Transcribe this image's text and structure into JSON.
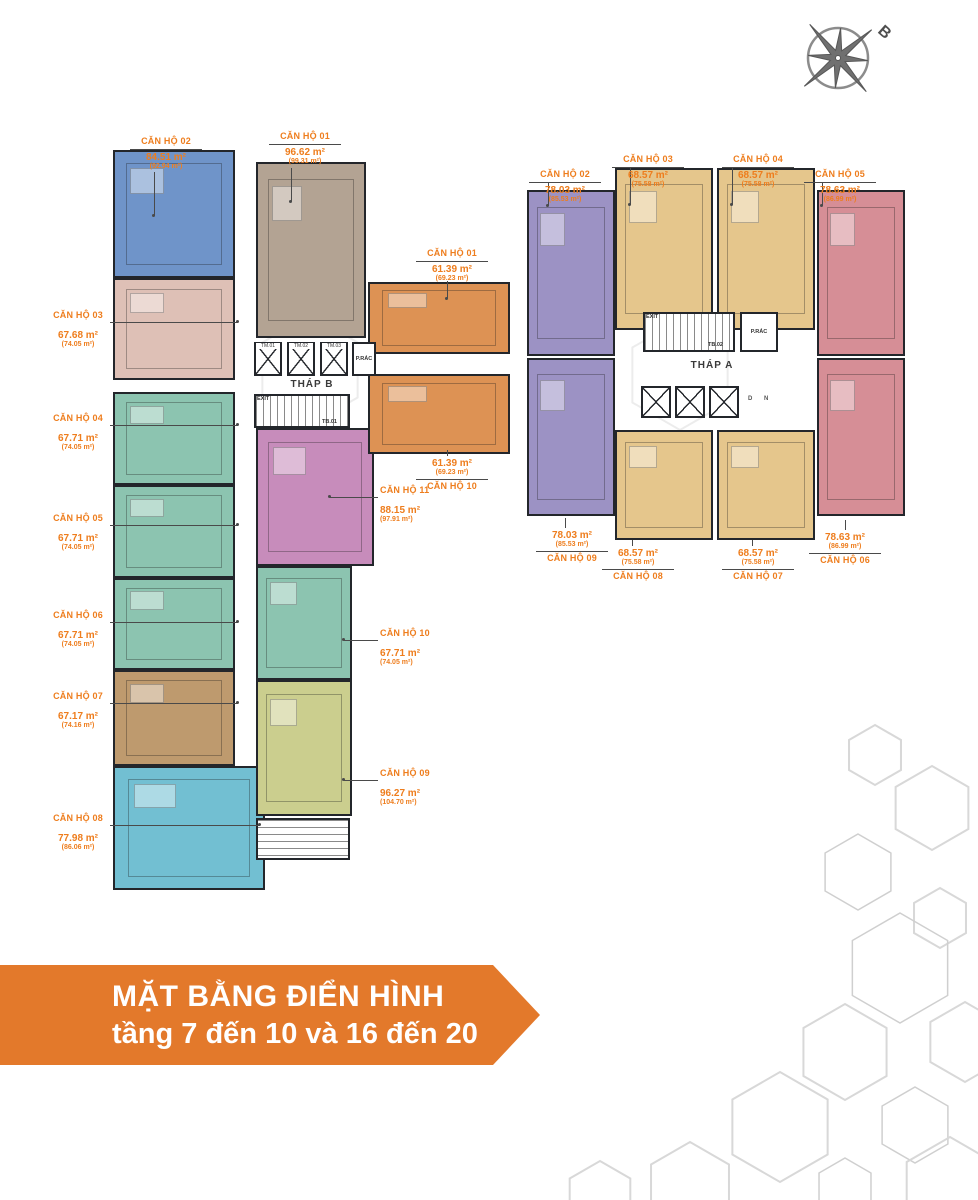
{
  "title_banner": {
    "line1": "MẶT BẰNG ĐIỂN HÌNH",
    "line2": "tầng 7 đến 10 và 16 đến 20",
    "bg_color": "#E3792B",
    "text_color": "#FFFFFF"
  },
  "compass": {
    "north_label": "B"
  },
  "palette": {
    "label_orange": "#EE7D1D",
    "wall": "#23262b",
    "blue": "#6F94C9",
    "taupe": "#B3A393",
    "pink": "#DEC0B6",
    "teal": "#8CC4B0",
    "tan": "#BE9A6E",
    "cyan": "#72BFD2",
    "magenta": "#C78CBB",
    "olive": "#CBCE8E",
    "orange": "#DD9254",
    "purple_a": "#9C92C4",
    "beige_a": "#E5C68C",
    "rose_a": "#D68E96",
    "hex_gray": "#D8D8D8"
  },
  "tower_b": {
    "name": "THÁP B",
    "core": {
      "elevators": [
        "TM.01",
        "TM.02",
        "TM.03"
      ],
      "trash_room": "P.RÁC",
      "exit": "EXIT",
      "stair": "TB.01"
    }
  },
  "tower_a": {
    "name": "THÁP A",
    "core": {
      "exit": "EXIT",
      "stair": "TB.02",
      "trash_room": "P.RÁC",
      "marker_d": "D",
      "marker_n": "N"
    }
  },
  "apartments": {
    "b01": {
      "name": "CĂN HỘ 01",
      "area": "96.62 m²",
      "gross": "(99.31 m²)"
    },
    "b02": {
      "name": "CĂN HỘ 02",
      "area": "84.51 m²",
      "gross": "(92.94 m²)"
    },
    "b03": {
      "name": "CĂN HỘ 03",
      "area": "67.68 m²",
      "gross": "(74.05 m²)"
    },
    "b04": {
      "name": "CĂN HỘ 04",
      "area": "67.71 m²",
      "gross": "(74.05 m²)"
    },
    "b05": {
      "name": "CĂN HỘ 05",
      "area": "67.71 m²",
      "gross": "(74.05 m²)"
    },
    "b06": {
      "name": "CĂN HỘ 06",
      "area": "67.71 m²",
      "gross": "(74.05 m²)"
    },
    "b07": {
      "name": "CĂN HỘ 07",
      "area": "67.17 m²",
      "gross": "(74.16 m²)"
    },
    "b08": {
      "name": "CĂN HỘ 08",
      "area": "77.98 m²",
      "gross": "(86.06 m²)"
    },
    "b09": {
      "name": "CĂN HỘ 09",
      "area": "96.27 m²",
      "gross": "(104.70 m²)"
    },
    "b10": {
      "name": "CĂN HỘ 10",
      "area": "67.71 m²",
      "gross": "(74.05 m²)"
    },
    "b11": {
      "name": "CĂN HỘ 11",
      "area": "88.15 m²",
      "gross": "(97.91 m²)"
    },
    "c01": {
      "name": "CĂN HỘ 01",
      "area": "61.39 m²",
      "gross": "(69.23 m²)"
    },
    "c10": {
      "name": "CĂN HỘ 10",
      "area": "61.39 m²",
      "gross": "(69.23 m²)"
    },
    "a02": {
      "name": "CĂN HỘ 02",
      "area": "78.03 m²",
      "gross": "(85.53 m²)"
    },
    "a03": {
      "name": "CĂN HỘ 03",
      "area": "68.57 m²",
      "gross": "(75.58 m²)"
    },
    "a04": {
      "name": "CĂN HỘ 04",
      "area": "68.57 m²",
      "gross": "(75.58 m²)"
    },
    "a05": {
      "name": "CĂN HỘ 05",
      "area": "78.63 m²",
      "gross": "(86.99 m²)"
    },
    "a06": {
      "name": "CĂN HỘ 06",
      "area": "78.63 m²",
      "gross": "(86.99 m²)"
    },
    "a07": {
      "name": "CĂN HỘ 07",
      "area": "68.57 m²",
      "gross": "(75.58 m²)"
    },
    "a08": {
      "name": "CĂN HỘ 08",
      "area": "68.57 m²",
      "gross": "(75.58 m²)"
    },
    "a09": {
      "name": "CĂN HỘ 09",
      "area": "78.03 m²",
      "gross": "(85.53 m²)"
    }
  }
}
